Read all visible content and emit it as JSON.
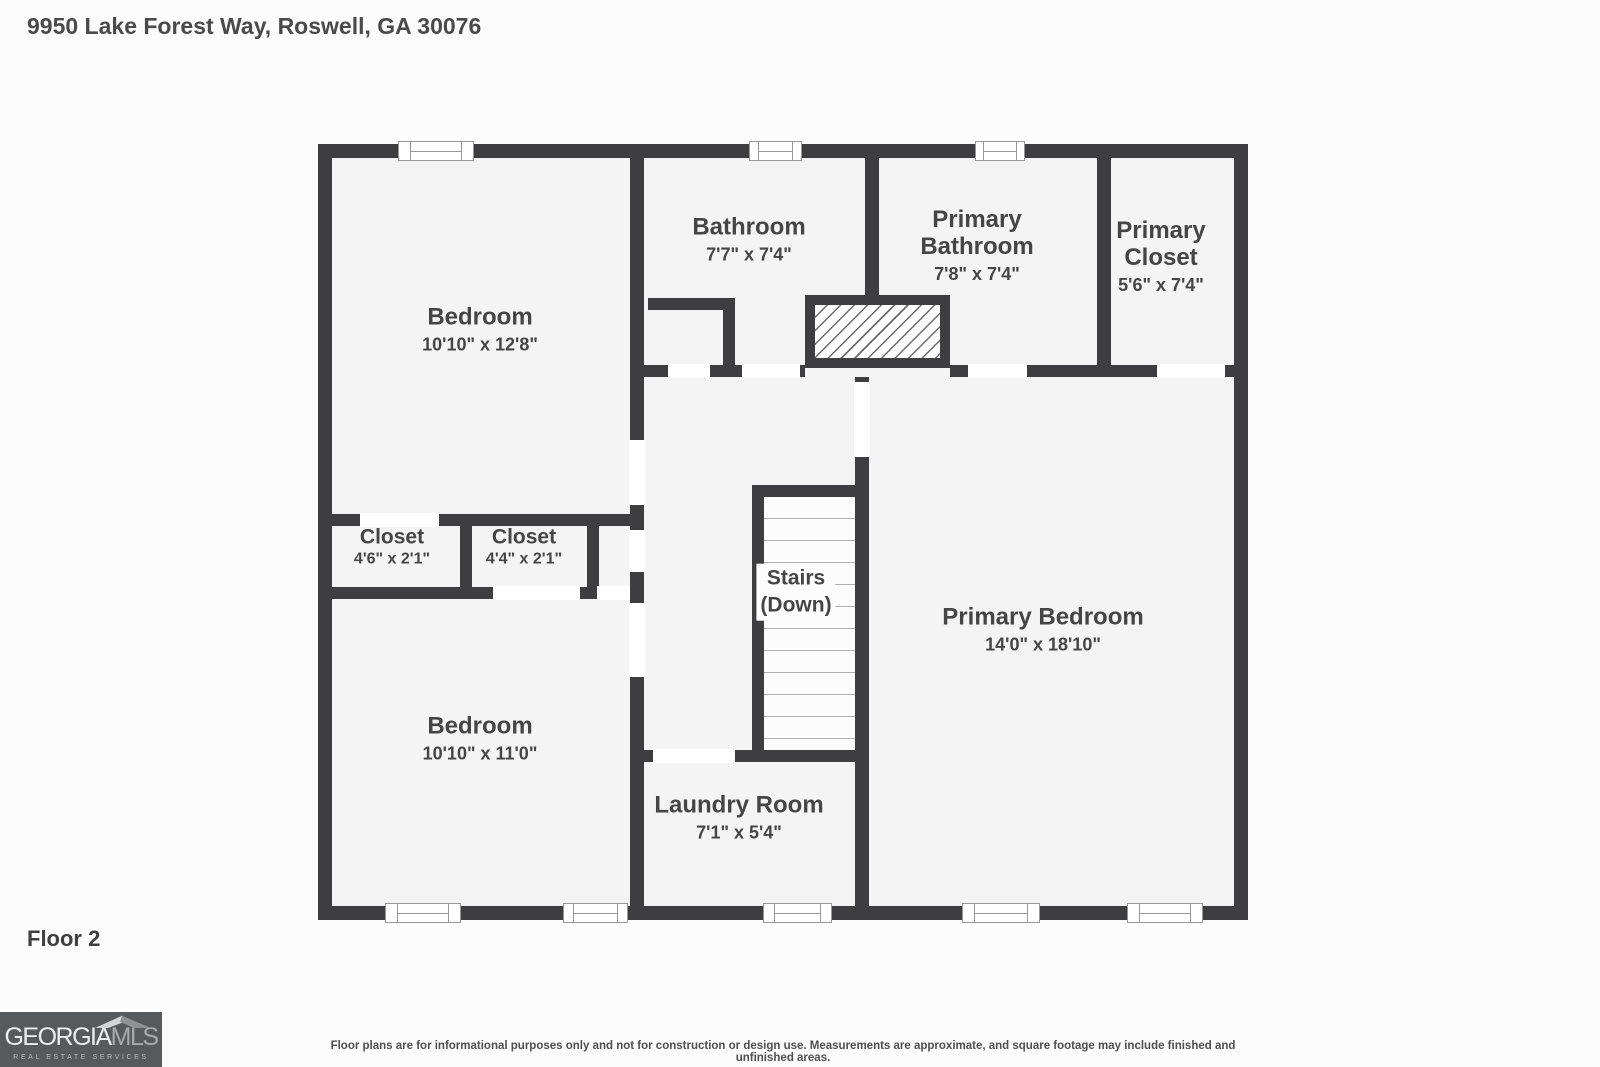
{
  "header": {
    "address": "9950 Lake Forest Way, Roswell, GA 30076"
  },
  "floor_label": "Floor 2",
  "rooms": {
    "bedroom_top": {
      "name": "Bedroom",
      "dims": "10'10\" x 12'8\""
    },
    "bathroom": {
      "name": "Bathroom",
      "dims": "7'7\" x 7'4\""
    },
    "primary_bathroom": {
      "name": "Primary Bathroom",
      "dims": "7'8\" x 7'4\""
    },
    "primary_closet": {
      "name": "Primary Closet",
      "dims": "5'6\" x 7'4\""
    },
    "closet_left": {
      "name": "Closet",
      "dims": "4'6\" x 2'1\""
    },
    "closet_right": {
      "name": "Closet",
      "dims": "4'4\" x 2'1\""
    },
    "bedroom_bottom": {
      "name": "Bedroom",
      "dims": "10'10\" x 11'0\""
    },
    "laundry": {
      "name": "Laundry Room",
      "dims": "7'1\" x 5'4\""
    },
    "primary_bedroom": {
      "name": "Primary Bedroom",
      "dims": "14'0\" x 18'10\""
    }
  },
  "stairs": {
    "line1": "Stairs",
    "line2": "(Down)"
  },
  "logo": {
    "part1": "GEORGIA",
    "part2": "MLS",
    "tagline": "REAL ESTATE SERVICES"
  },
  "disclaimer": "Floor plans are for informational purposes only and not for construction or design use. Measurements are approximate, and square footage may include finished and unfinished areas.",
  "colors": {
    "wall": "#3e3e40",
    "floor": "#f4f4f4",
    "page": "#fcfcfc",
    "logo_bg": "#58595b",
    "text": "#454545"
  }
}
